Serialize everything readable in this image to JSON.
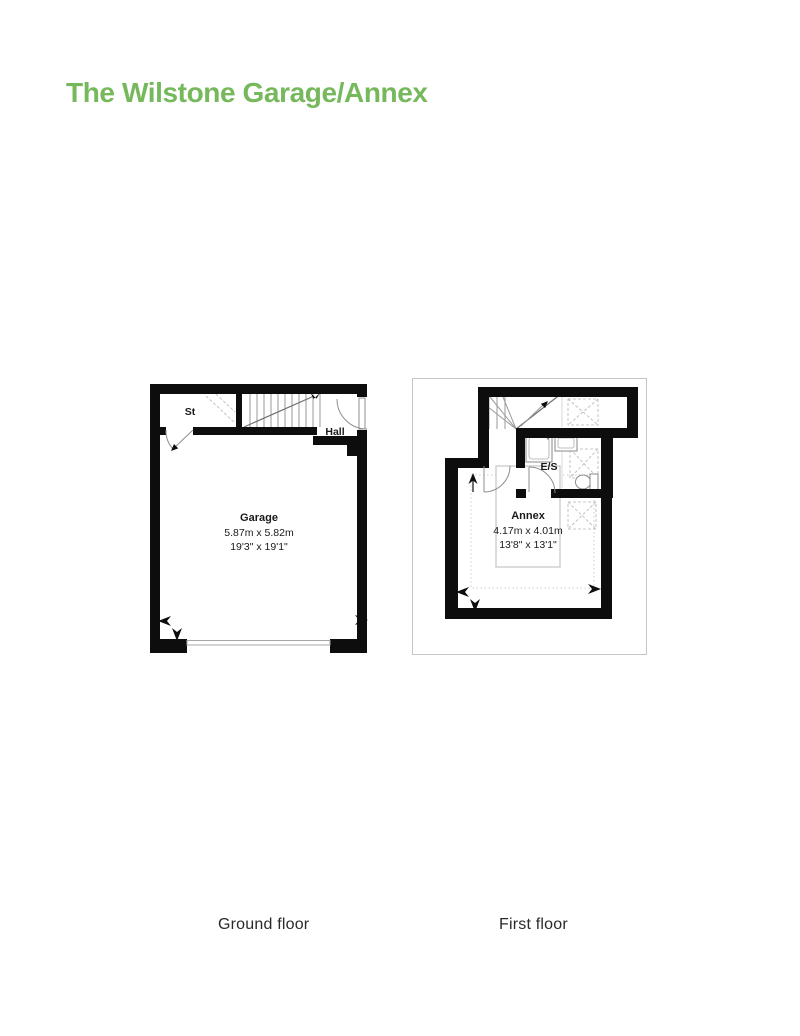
{
  "title": "The Wilstone Garage/Annex",
  "accent_color": "#76b85c",
  "ground_floor": {
    "caption": "Ground floor",
    "rooms": {
      "st": {
        "label": "St"
      },
      "hall": {
        "label": "Hall"
      },
      "garage": {
        "label": "Garage",
        "metric": "5.87m x 5.82m",
        "imperial": "19'3\" x 19'1\""
      }
    }
  },
  "first_floor": {
    "caption": "First floor",
    "rooms": {
      "es": {
        "label": "E/S"
      },
      "annex": {
        "label": "Annex",
        "metric": "4.17m x 4.01m",
        "imperial": "13'8\" x 13'1\""
      }
    }
  }
}
